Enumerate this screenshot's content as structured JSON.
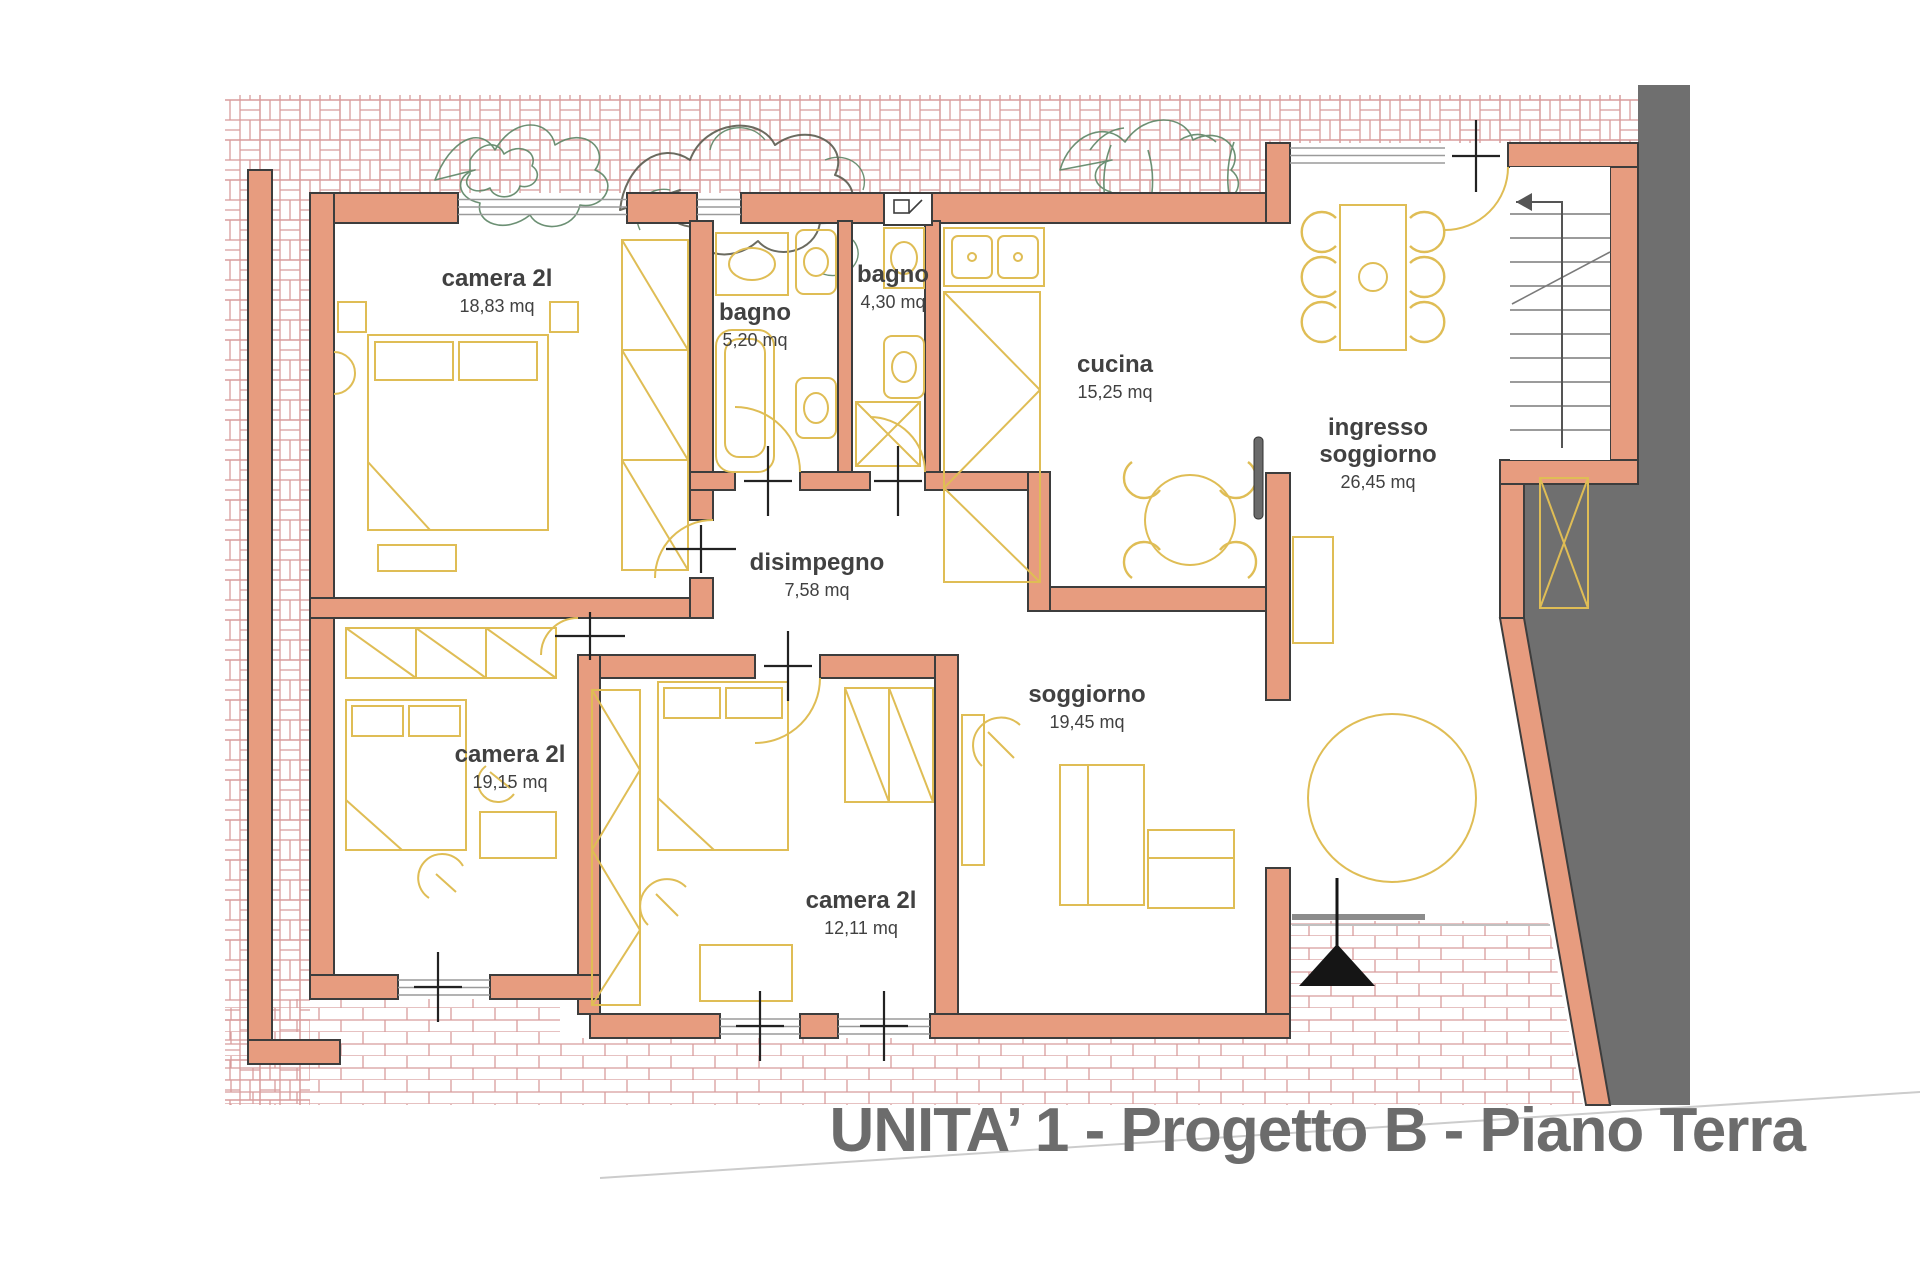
{
  "title": {
    "text": "UNITA’ 1 - Progetto B - Piano Terra"
  },
  "rooms": [
    {
      "name": "camera 2l",
      "area": "18,83 mq"
    },
    {
      "name": "bagno",
      "area": "5,20 mq"
    },
    {
      "name": "bagno",
      "area": "4,30 mq"
    },
    {
      "name": "cucina",
      "area": "15,25 mq"
    },
    {
      "name": "ingresso soggiorno",
      "area": "26,45 mq"
    },
    {
      "name": "disimpegno",
      "area": "7,58 mq"
    },
    {
      "name": "soggiorno",
      "area": "19,45 mq"
    },
    {
      "name": "camera 2l",
      "area": "19,15 mq"
    },
    {
      "name": "camera 2l",
      "area": "12,11 mq"
    }
  ],
  "colors": {
    "wall": "#e79c7f",
    "wall_outline": "#3d3d3d",
    "furniture": "#dfbd55",
    "paving_line": "#d89c9c",
    "gray_area": "#6f6f6f",
    "label_text": "#414141",
    "title_text": "#6c6c6c",
    "vegetation": "#5d8565"
  }
}
